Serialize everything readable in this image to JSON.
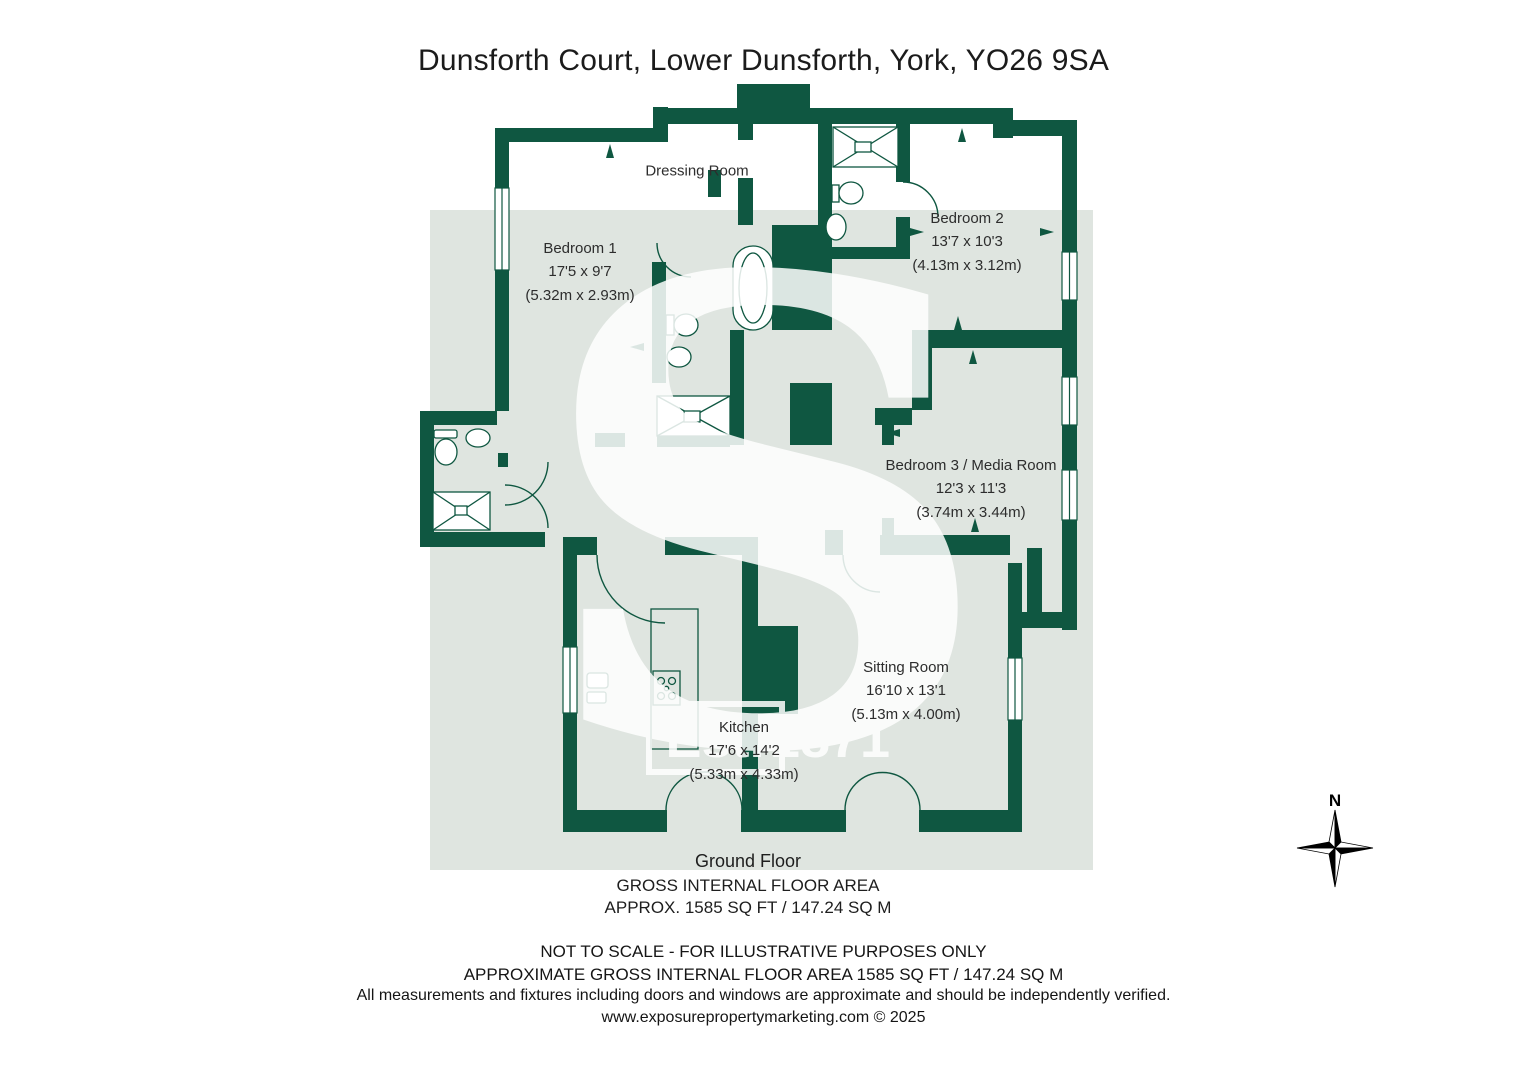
{
  "title": "Dunsforth Court, Lower Dunsforth, York, YO26 9SA",
  "rooms": {
    "bedroom1": {
      "name": "Bedroom 1",
      "size_imperial": "17'5 x 9'7",
      "size_metric": "(5.32m x 2.93m)"
    },
    "dressing": {
      "name": "Dressing Room"
    },
    "bedroom2": {
      "name": "Bedroom 2",
      "size_imperial": "13'7 x 10'3",
      "size_metric": "(4.13m x 3.12m)"
    },
    "bedroom3": {
      "name": "Bedroom 3 / Media Room",
      "size_imperial": "12'3 x 11'3",
      "size_metric": "(3.74m x 3.44m)"
    },
    "sitting": {
      "name": "Sitting Room",
      "size_imperial": "16'10 x 13'1",
      "size_metric": "(5.13m x 4.00m)"
    },
    "kitchen": {
      "name": "Kitchen",
      "size_imperial": "17'6 x 14'2",
      "size_metric": "(5.33m x 4.33m)"
    }
  },
  "footer": {
    "floor_label": "Ground Floor",
    "area_heading": "GROSS INTERNAL FLOOR AREA",
    "area_value": "APPROX. 1585 SQ FT / 147.24 SQ M",
    "line1": "NOT TO SCALE - FOR ILLUSTRATIVE PURPOSES ONLY",
    "line2": "APPROXIMATE GROSS INTERNAL FLOOR AREA 1585 SQ FT / 147.24 SQ M",
    "line3": "All measurements and fixtures including doors and windows are approximate and should be independently verified.",
    "line4": "www.exposurepropertymarketing.com © 2025"
  },
  "watermark": {
    "letter": "S",
    "est": "Est.",
    "year": "1871"
  },
  "compass": {
    "north_label": "N"
  },
  "colors": {
    "wall_green": "#0F5741",
    "floor_tint": "#DFE5E0"
  }
}
